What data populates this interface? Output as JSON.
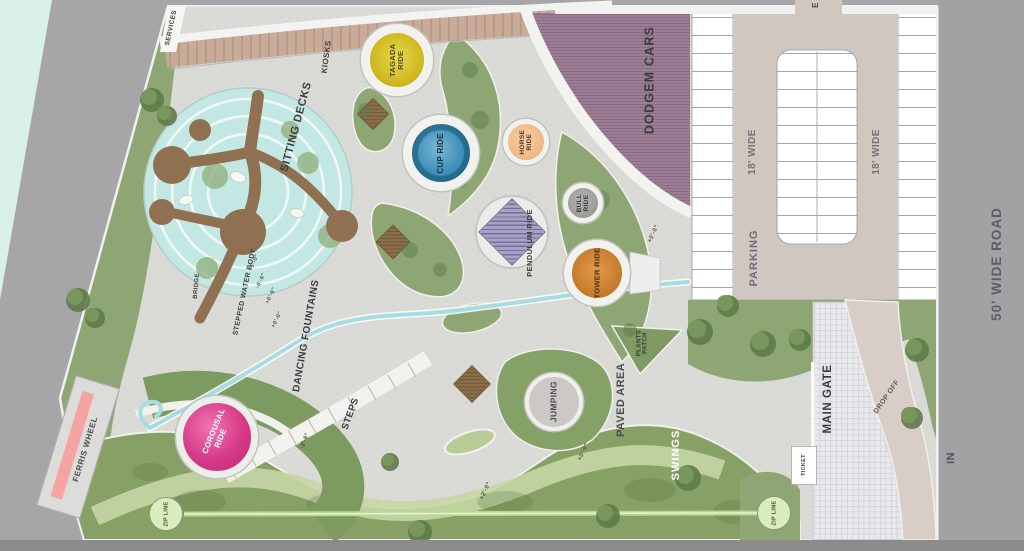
{
  "plan": {
    "type": "amusement park master plan (top view site plan)"
  },
  "labels": {
    "services": "SERVICES",
    "kiosks": "KIOSKS",
    "sitting_decks": "SITTING DECKS",
    "tagada": "TAGADA RIDE",
    "cup": "CUP RIDE",
    "horse": "HORSE RIDE",
    "bull": "BULL RIDE",
    "pendulum": "PENDULUM RIDE",
    "tower": "TOWER RIDE",
    "dodgem": "DODGEM CARS",
    "exit_e": "E",
    "aisle_left": "18' WIDE",
    "aisle_right": "18' WIDE",
    "parking": "PARKING",
    "road": "50' WIDE ROAD",
    "in_lane": "IN",
    "main_gate": "MAIN GATE",
    "drop_off": "DROP OFF",
    "ticket": "TICKET",
    "zip_line_a": "ZIP LINE",
    "zip_line_b": "ZIP LINE",
    "ferris": "FERRIS WHEEL",
    "carousal": "COROUSAL RIDE",
    "steps": "STEPS",
    "dancing": "DANCING FOUNTAINS",
    "stepped_wb": "STEPPED WATER BODY",
    "bridge": "BRIDGE",
    "jumping": "JUMPING",
    "paved": "PAVED AREA",
    "plants": "PLANTS PATCH",
    "swings": "SWINGS"
  },
  "dimensions": {
    "wb1": "+1'-0\"",
    "wb2": "-0'-6\"",
    "wb3": "+0'-6\"",
    "wb4": "+0'-0\"",
    "steps": "-2'-6\"",
    "paved": "+0'-0\"",
    "tower": "+0'-0\"",
    "swings": "+2'-0\""
  },
  "colors": {
    "tagada_yellow": "#cdb71f",
    "cup_blue": "#3f93ba",
    "horse_peach": "#f2bd8d",
    "bull_gray": "#9e9e9c",
    "pendulum_purple": "#9a97bd",
    "tower_orange": "#c87f2f",
    "carousal_pink": "#d2357f",
    "dodgem_mauve": "#9c7f96",
    "water_cyan": "#c3e8e4",
    "lawn_green": "#8ea673",
    "paved_gray": "#dadad6",
    "road_gray": "#a4a4a6",
    "zip_green": "#d9edbf",
    "ferris_stripe_pink": "#f4a5a2"
  }
}
